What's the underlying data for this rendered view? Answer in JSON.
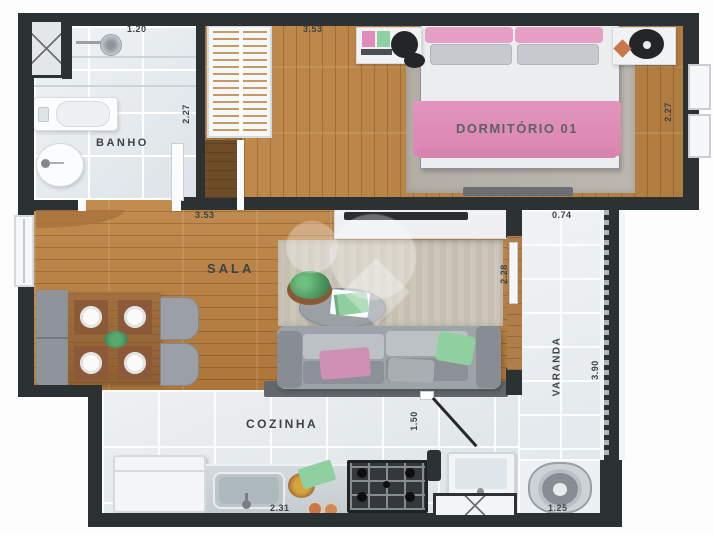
{
  "plan": {
    "rooms": {
      "bathroom": "BANHO",
      "bedroom": "DORMITÓRIO 01",
      "living": "SALA",
      "kitchen": "COZINHA",
      "balcony": "VARANDA"
    },
    "dimensions": {
      "bathroom_width": "1.20",
      "bedroom_width": "3.53",
      "bathroom_depth": "2.27",
      "bedroom_depth": "2.27",
      "living_width": "3.53",
      "balcony_top_width": "0.74",
      "balcony_door_height": "2.28",
      "balcony_length": "3.90",
      "kitchen_passage": "1.50",
      "kitchen_counter_width": "2.31",
      "laundry_width": "1.25"
    }
  },
  "colors": {
    "wall": "#2c3134",
    "wood_floor": "#b9834a",
    "tile_floor": "#e6eaed",
    "accent_pink": "#df8eb9",
    "accent_green": "#8ed0a0"
  }
}
